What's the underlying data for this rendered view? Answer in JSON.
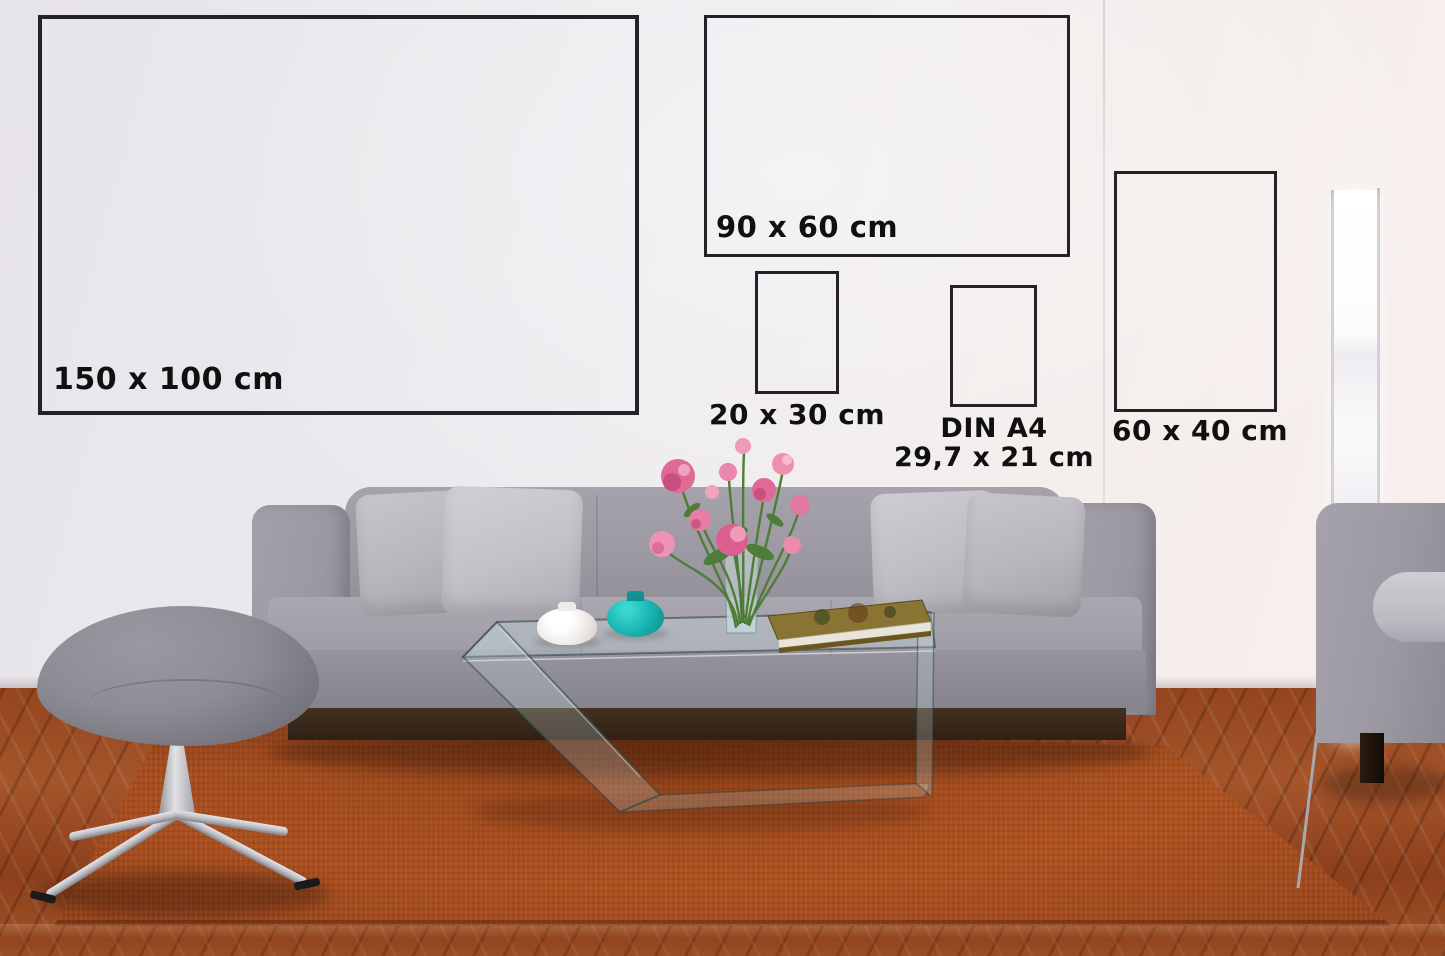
{
  "frames": [
    {
      "id": "150x100",
      "label": "150 x 100 cm"
    },
    {
      "id": "90x60",
      "label": "90 x 60 cm"
    },
    {
      "id": "20x30",
      "label": "20 x 30 cm"
    },
    {
      "id": "din-a4",
      "label": "DIN A4",
      "sublabel": "29,7 x 21 cm"
    },
    {
      "id": "60x40",
      "label": "60 x 40 cm"
    }
  ],
  "colors": {
    "frame_border": "#222228",
    "label_text": "#101010",
    "wall": "#edeaee",
    "rug": "#b0521f",
    "floor_wood": "#94451e",
    "sofa": "#9b98a1",
    "pillow": "#b8b6bd",
    "plinth": "#2f2115",
    "teal_vase": "#17b2af",
    "white_vase": "#efe9e6",
    "flower_pink": "#e06a96",
    "stem_green": "#4e7d38",
    "book_cover": "#8a7434",
    "chrome": "#b9b9bf",
    "lamp_rail": "#b3b4ba"
  },
  "scene": {
    "objects": [
      "wall",
      "wood-floor",
      "orange-rug",
      "gray-sofa",
      "pillows",
      "glass-coffee-table",
      "pink-flower-bouquet",
      "glass-flower-vase",
      "white-vase",
      "teal-vase",
      "book",
      "gray-stool",
      "floor-lamp",
      "side-sofa"
    ]
  }
}
